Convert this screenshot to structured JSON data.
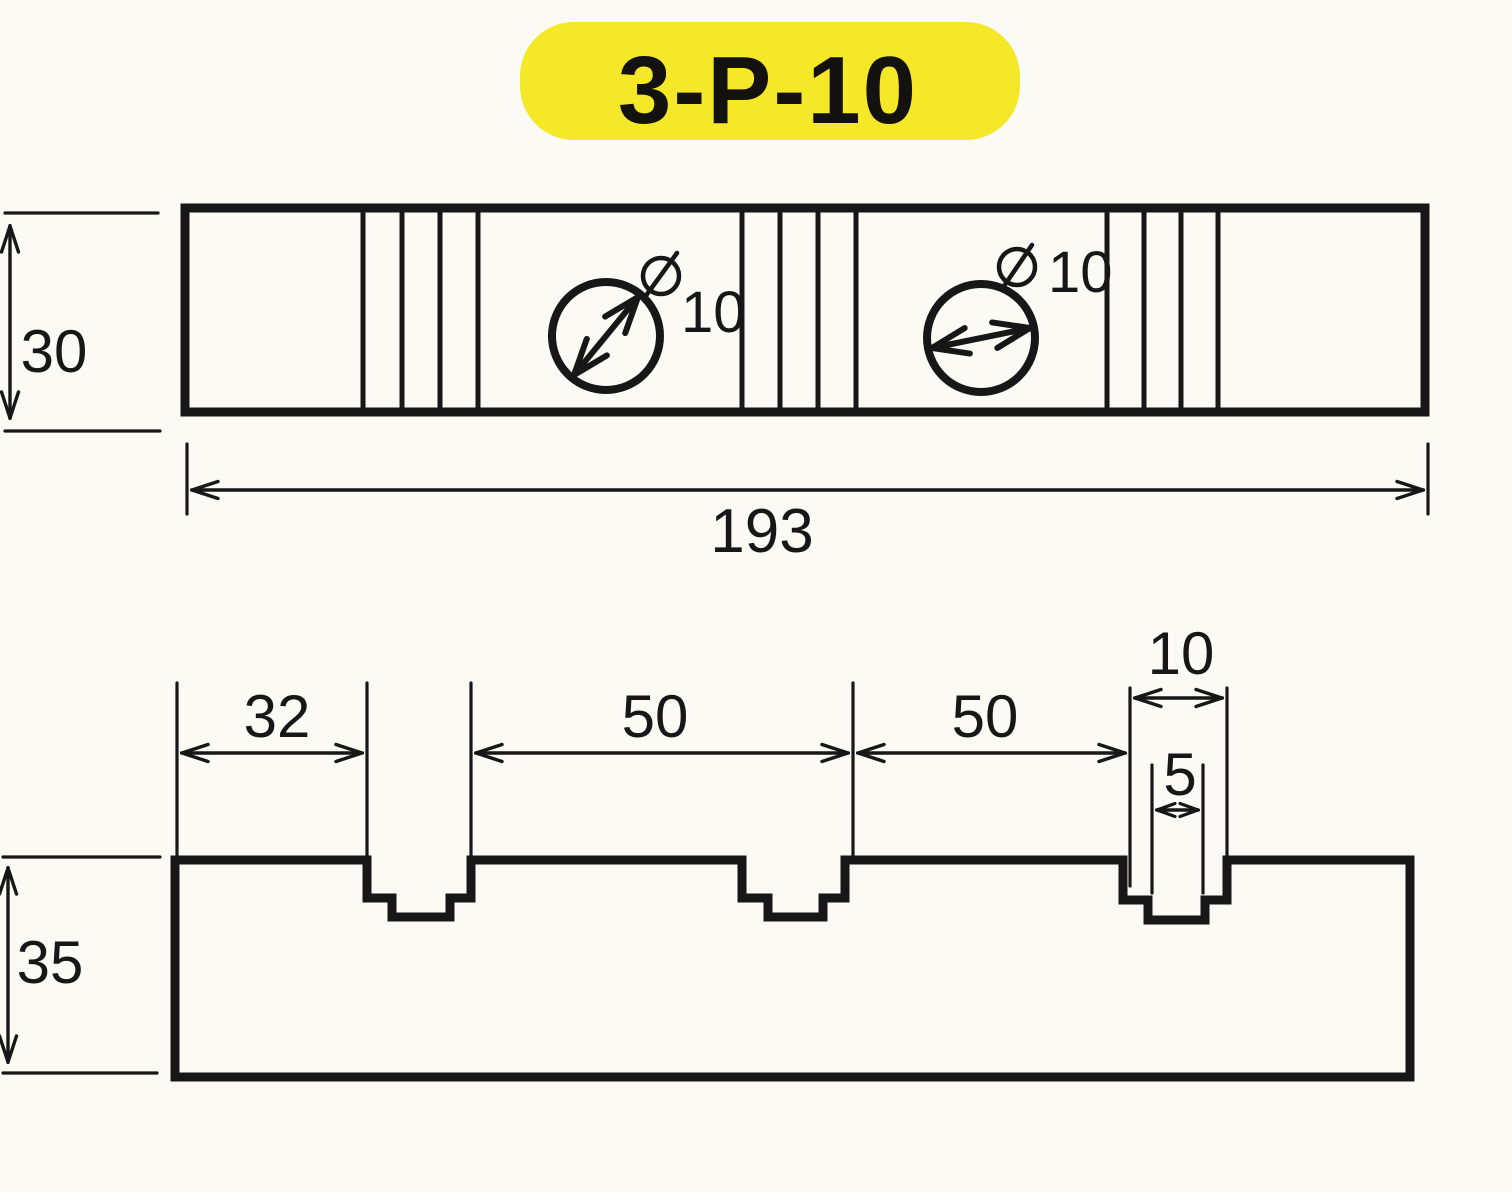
{
  "badge": {
    "text": "3-P-10",
    "bg_color": "#f4e829"
  },
  "top_view": {
    "height_dim": "30",
    "length_dim": "193",
    "hole1": {
      "diameter_symbol": "circle-slash",
      "label": "10"
    },
    "hole2": {
      "diameter_symbol": "circle-slash",
      "label": "10"
    }
  },
  "section_view": {
    "height_dim": "35",
    "left_offset_dim": "32",
    "spacing_dim_1": "50",
    "spacing_dim_2": "50",
    "slot_width_dim": "10",
    "slot_inner_width_dim": "5"
  },
  "colors": {
    "ink": "#171717",
    "paper": "#fbfaf5"
  }
}
